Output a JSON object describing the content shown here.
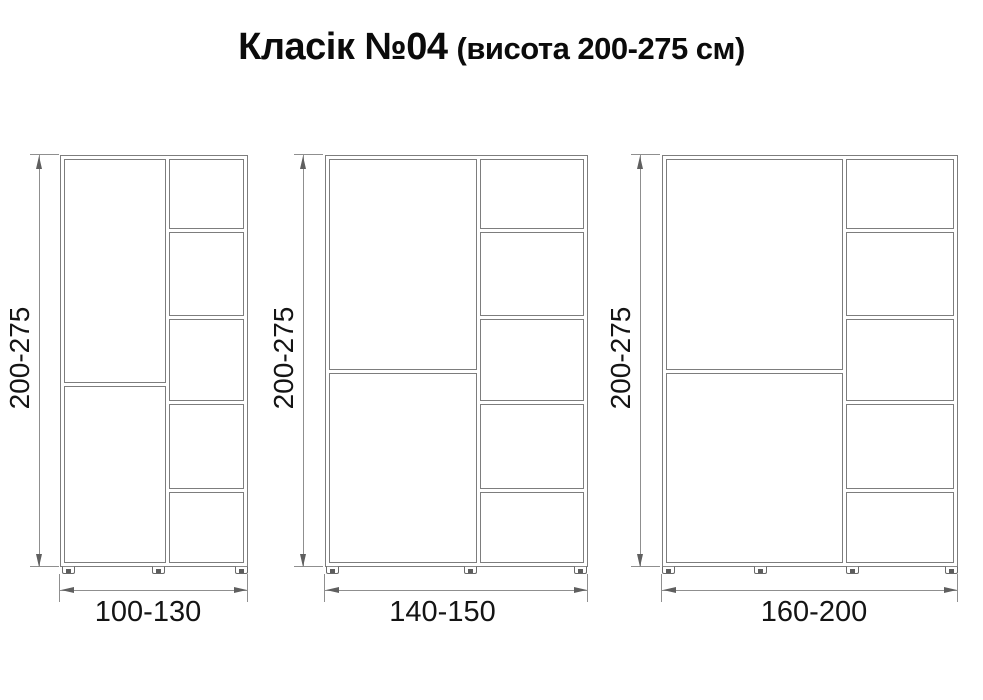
{
  "title": {
    "main": "Класік №04",
    "subtitle": "(висота 200-275 см)"
  },
  "cabinets": [
    {
      "height_label": "200-275",
      "width_label": "100-130"
    },
    {
      "height_label": "200-275",
      "width_label": "140-150"
    },
    {
      "height_label": "200-275",
      "width_label": "160-200"
    }
  ],
  "colors": {
    "drawing_line": "#7d7d7d",
    "dimension_line": "#8f8f8f",
    "text": "#141414",
    "background": "#ffffff"
  }
}
